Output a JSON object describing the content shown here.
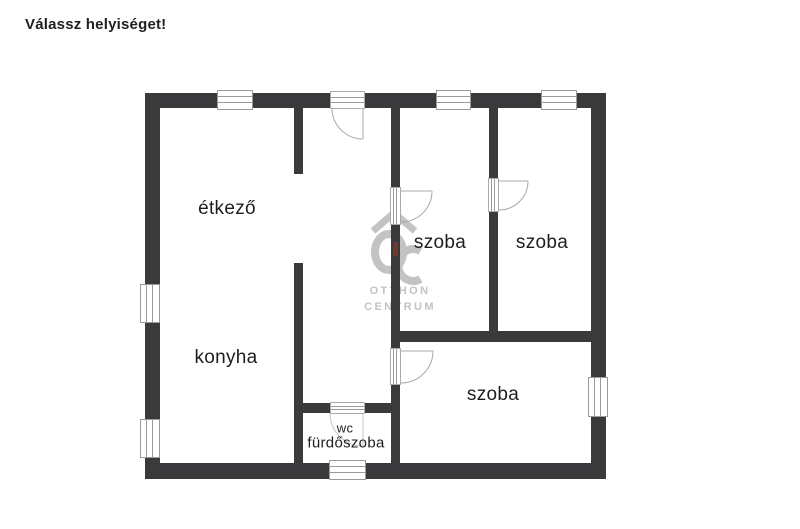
{
  "header": {
    "title": "Válassz helyiséget!"
  },
  "watermark": {
    "monogram": "OC",
    "line1": "OTTHON",
    "line2": "CENTRUM",
    "gray": "#c3c3c3",
    "accent_color": "#7a3a2c"
  },
  "floorplan": {
    "wall_color": "#3a3a3c",
    "label_color": "#1e1e1e",
    "rooms": [
      {
        "id": "etkezo",
        "label": "étkező",
        "x": 227,
        "y": 209,
        "size": 19
      },
      {
        "id": "konyha",
        "label": "konyha",
        "x": 226,
        "y": 358,
        "size": 19
      },
      {
        "id": "szoba-1",
        "label": "szoba",
        "x": 440,
        "y": 243,
        "size": 19
      },
      {
        "id": "szoba-2",
        "label": "szoba",
        "x": 542,
        "y": 243,
        "size": 19
      },
      {
        "id": "szoba-3",
        "label": "szoba",
        "x": 493,
        "y": 395,
        "size": 19
      },
      {
        "id": "wc",
        "label": "wc",
        "x": 345,
        "y": 428,
        "size": 13
      },
      {
        "id": "furdoszoba",
        "label": "fürdőszoba",
        "x": 346,
        "y": 443,
        "size": 15
      }
    ],
    "walls": [
      {
        "x": 145,
        "y": 93,
        "w": 461,
        "h": 15
      },
      {
        "x": 145,
        "y": 463,
        "w": 461,
        "h": 16
      },
      {
        "x": 145,
        "y": 93,
        "w": 15,
        "h": 386
      },
      {
        "x": 591,
        "y": 93,
        "w": 15,
        "h": 386
      },
      {
        "x": 294,
        "y": 108,
        "w": 9,
        "h": 66
      },
      {
        "x": 294,
        "y": 263,
        "w": 9,
        "h": 200
      },
      {
        "x": 391,
        "y": 108,
        "w": 9,
        "h": 80
      },
      {
        "x": 391,
        "y": 225,
        "w": 9,
        "h": 123
      },
      {
        "x": 391,
        "y": 385,
        "w": 9,
        "h": 78
      },
      {
        "x": 489,
        "y": 108,
        "w": 9,
        "h": 70
      },
      {
        "x": 489,
        "y": 212,
        "w": 9,
        "h": 119
      },
      {
        "x": 391,
        "y": 331,
        "w": 200,
        "h": 11
      },
      {
        "x": 303,
        "y": 403,
        "w": 27,
        "h": 10
      },
      {
        "x": 365,
        "y": 403,
        "w": 26,
        "h": 10
      }
    ],
    "windows": [
      {
        "x": 217,
        "y": 90,
        "w": 36,
        "h": 20,
        "o": "h"
      },
      {
        "x": 436,
        "y": 90,
        "w": 35,
        "h": 20,
        "o": "h"
      },
      {
        "x": 541,
        "y": 90,
        "w": 36,
        "h": 20,
        "o": "h"
      },
      {
        "x": 329,
        "y": 460,
        "w": 37,
        "h": 20,
        "o": "h"
      },
      {
        "x": 140,
        "y": 284,
        "w": 20,
        "h": 39,
        "o": "v"
      },
      {
        "x": 140,
        "y": 419,
        "w": 20,
        "h": 39,
        "o": "v"
      },
      {
        "x": 588,
        "y": 377,
        "w": 20,
        "h": 40,
        "o": "v"
      }
    ],
    "doors": [
      {
        "frame": {
          "x": 330,
          "y": 91,
          "w": 35,
          "h": 18,
          "o": "h"
        },
        "path": "M363,108 L363,139 M332,108 A31,31 0 0 0 363,139",
        "faint": false
      },
      {
        "frame": {
          "x": 390,
          "y": 187,
          "w": 11,
          "h": 38,
          "o": "v"
        },
        "path": "M401,191 L432,191 M432,191 A31,31 0 0 1 401,222",
        "faint": false
      },
      {
        "frame": {
          "x": 488,
          "y": 178,
          "w": 11,
          "h": 34,
          "o": "v"
        },
        "path": "M499,181 L528,181 M528,181 A29,29 0 0 1 499,210",
        "faint": false
      },
      {
        "frame": {
          "x": 390,
          "y": 348,
          "w": 11,
          "h": 37,
          "o": "v"
        },
        "path": "M401,351 L433,351 M433,351 A32,32 0 0 1 401,383",
        "faint": false
      },
      {
        "frame": {
          "x": 330,
          "y": 402,
          "w": 35,
          "h": 12,
          "o": "h"
        },
        "path": "M363,413 L363,446 M330,413 A33,33 0 0 0 363,446",
        "faint": true
      }
    ]
  }
}
